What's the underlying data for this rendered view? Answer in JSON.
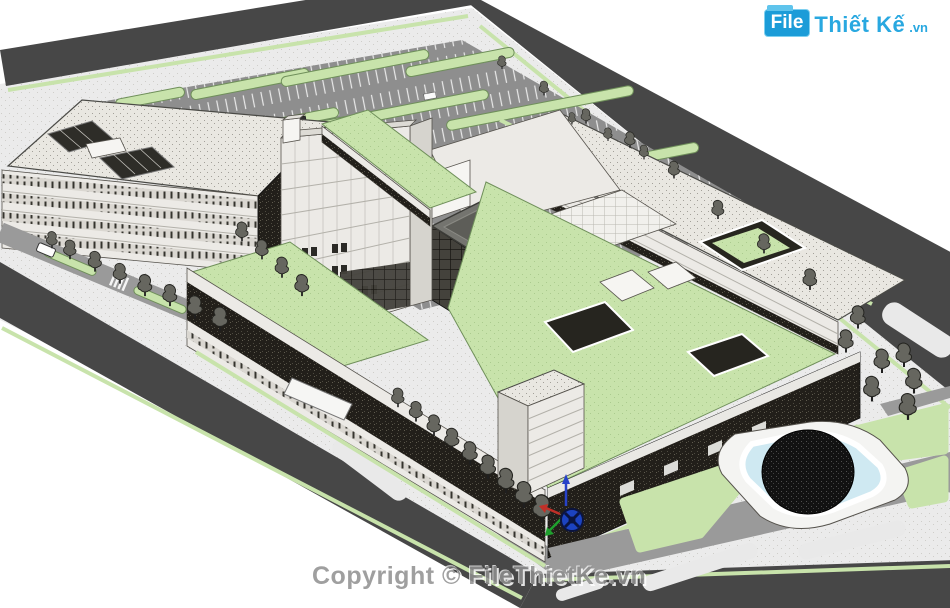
{
  "page": {
    "background": "#ffffff",
    "view_type": "axonometric 3D site model"
  },
  "branding": {
    "logo": {
      "box_text": "File",
      "name_text": "Thiết Kế",
      "domain_text": ".vn"
    },
    "copyright_watermark": "Copyright © FileThietKe.vn"
  },
  "palette": {
    "road": "#474747",
    "asphalt": "#8e8e8e",
    "pavement": "#ebebeb",
    "lawn": "#c8e3ab",
    "roof_light": "#e9e7e2",
    "facade_dark": "#221f1a",
    "facade_light": "#eceae6",
    "water": "#cfe9f2",
    "dome": "#121212",
    "helipad_red": "#ad5f58",
    "logo_blue": "#29a8e0",
    "logo_box": "#1b9cd8",
    "tree": "#66665f"
  },
  "scene": {
    "elements": [
      {
        "name": "perimeter-road",
        "desc": "dark ring road around site"
      },
      {
        "name": "parking-lot",
        "desc": "striped surface parking with green islands"
      },
      {
        "name": "office-building-left",
        "desc": "4-storey block, two roof courtyards"
      },
      {
        "name": "central-tower",
        "desc": "7-storey white tower"
      },
      {
        "name": "helipad",
        "desc": "rooftop helipad with red cross"
      },
      {
        "name": "long-wing",
        "desc": "low wing with stippled roof"
      },
      {
        "name": "green-roof-terrace",
        "desc": "planted podium roofs with sunken courts"
      },
      {
        "name": "dark-podium",
        "desc": "dark brick street facade with trees"
      },
      {
        "name": "pond-dome",
        "desc": "black dome pavilion in pond, lawns"
      },
      {
        "name": "axis-gizmo",
        "desc": "model origin marker"
      }
    ]
  }
}
